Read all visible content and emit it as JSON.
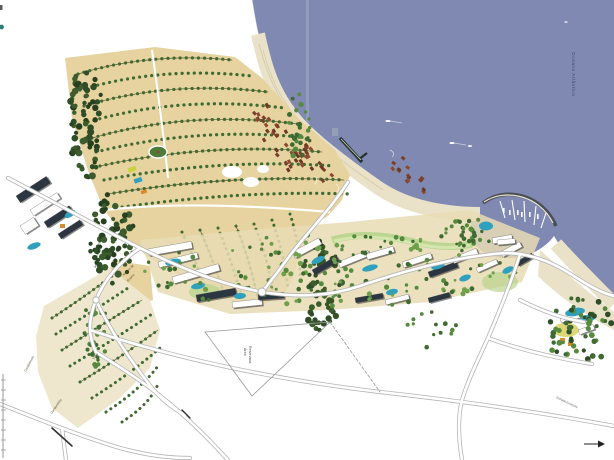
{
  "map": {
    "kind": "coastal-resort-master-plan",
    "ocean_label": "Oceano Atlântico",
    "labels": {
      "reserved_area_line1": "Área",
      "reserved_area_line2": "Reservada",
      "nucleo_line1": "Núcleo de",
      "nucleo_line2": "Ensino",
      "vilas": "Vilas",
      "condominio": "Condomínio",
      "condominio2": "Condomínio",
      "preservation": "Área de Preservação",
      "road": "Estrada Existente"
    },
    "icons": {
      "direction_arrow": "▶"
    },
    "colors": {
      "sea": "#8089b2",
      "sand": "#e6d3a0",
      "sandPale": "#efe7cd",
      "beach": "#e9e2c9",
      "beachEdge": "#d9cfae",
      "forest": "#2f4d27",
      "tree": "#3f6b33",
      "treeLight": "#6fa04c",
      "lawn": "#b9d48e",
      "roof": "#7a3f2a",
      "pool": "#2fa0bd",
      "roadCasing": "#b5b5b5",
      "road": "#ffffff",
      "label": "#555555",
      "oceanLabel": "#3d4a6b"
    }
  }
}
